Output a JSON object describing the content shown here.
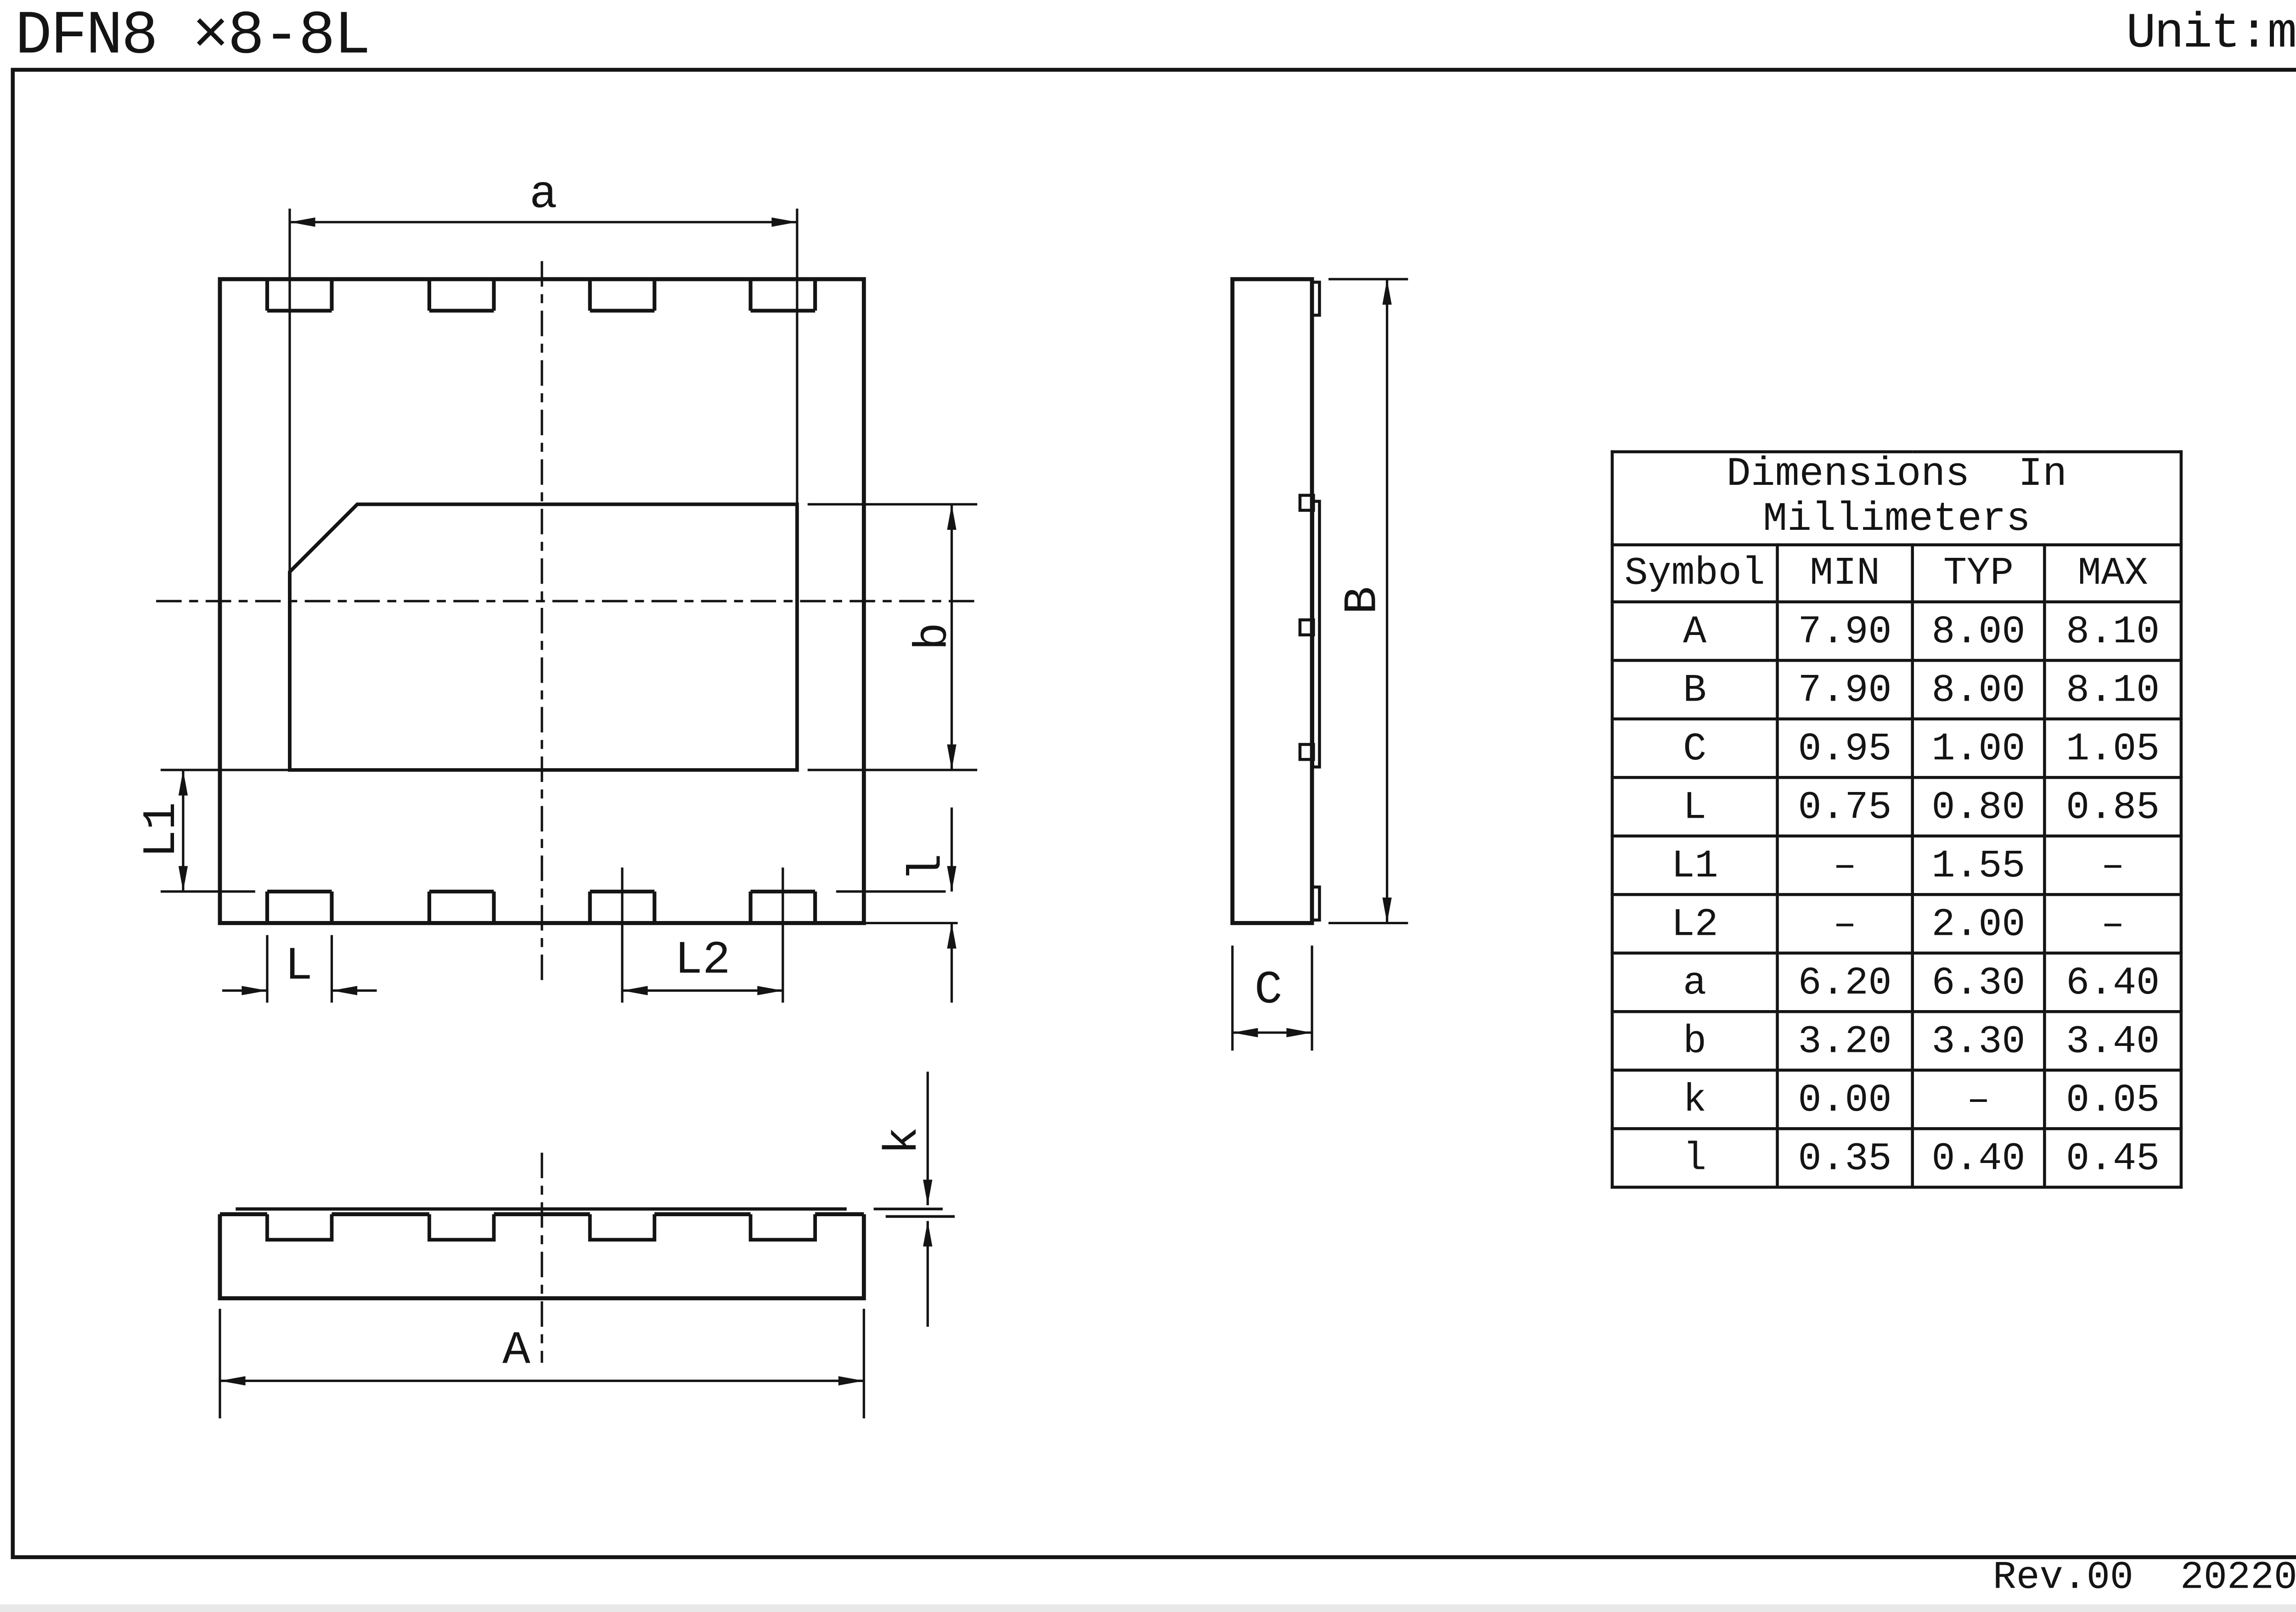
{
  "meta": {
    "title": "DFN8 ×8-8L",
    "unit": "Unit:mm",
    "revision": "Rev.00  202207"
  },
  "labels": {
    "a": "a",
    "b": "b",
    "k": "k",
    "l": "l",
    "A": "A",
    "B": "B",
    "C": "C",
    "L": "L",
    "L1": "L1",
    "L2": "L2"
  },
  "table": {
    "title_line1": "Dimensions  In",
    "title_line2": "Millimeters",
    "headers": [
      "Symbol",
      "MIN",
      "TYP",
      "MAX"
    ],
    "rows": [
      {
        "symbol": "A",
        "min": "7.90",
        "typ": "8.00",
        "max": "8.10"
      },
      {
        "symbol": "B",
        "min": "7.90",
        "typ": "8.00",
        "max": "8.10"
      },
      {
        "symbol": "C",
        "min": "0.95",
        "typ": "1.00",
        "max": "1.05"
      },
      {
        "symbol": "L",
        "min": "0.75",
        "typ": "0.80",
        "max": "0.85"
      },
      {
        "symbol": "L1",
        "min": "–",
        "typ": "1.55",
        "max": "–"
      },
      {
        "symbol": "L2",
        "min": "–",
        "typ": "2.00",
        "max": "–"
      },
      {
        "symbol": "a",
        "min": "6.20",
        "typ": "6.30",
        "max": "6.40"
      },
      {
        "symbol": "b",
        "min": "3.20",
        "typ": "3.30",
        "max": "3.40"
      },
      {
        "symbol": "k",
        "min": "0.00",
        "typ": "–",
        "max": "0.05"
      },
      {
        "symbol": "l",
        "min": "0.35",
        "typ": "0.40",
        "max": "0.45"
      }
    ]
  },
  "colors": {
    "line": "#141414",
    "background": "#ffffff"
  }
}
